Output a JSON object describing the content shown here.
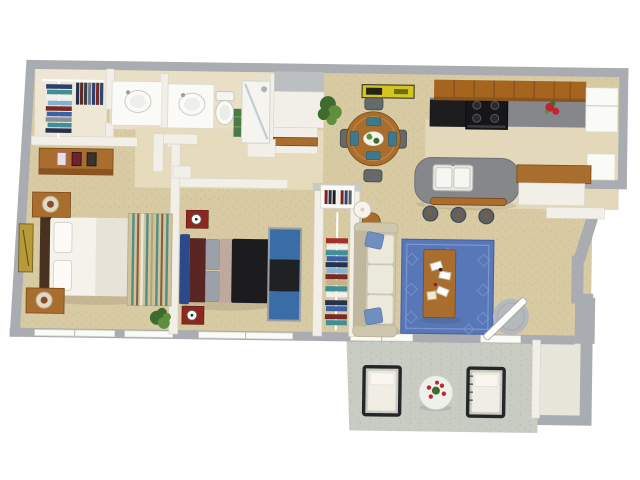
{
  "palette": {
    "bg": "#ffffff",
    "wall": "#a9acb0",
    "wallLight": "#bcbfc2",
    "partition": "#f2efe8",
    "partitionEdge": "#d9d4c8",
    "carpet": "#d8cba4",
    "tileBath": "#e9dfc6",
    "tileHall": "#e6dbbd",
    "tileKitchen": "#e3d8ba",
    "closetFloor": "#eee7d6",
    "concrete": "#c8ccc3",
    "storageFloor": "#e6e6da",
    "wood": "#a96e2e",
    "woodDark": "#7a4a16",
    "woodCab": "#a5651f",
    "counter": "#85878a",
    "applianceBlack": "#1d1d20",
    "white": "#fafaf6",
    "bedWhite": "#f4f2ea",
    "bedThrow": "#e7e3d8",
    "headboard": "#46321f",
    "sofa": "#cfc6ae",
    "sofaBack": "#c0b79e",
    "cushion": "#ebe8dc",
    "pillowBlue": "#6f8fc0",
    "rugBlue": "#5877b8",
    "rugBlueLine": "#7e96cc",
    "rug2Blue": "#3a6ca6",
    "rug2Black": "#202124",
    "rug2Border": "#9aa0a6",
    "bed2Blue": "#2b4a8c",
    "bed2Maroon": "#5a2522",
    "bed2Gray": "#9aa1a8",
    "bed2Tan": "#bfa89e",
    "bed2Black": "#1c1c1f",
    "nightstandRed": "#8f2720",
    "artGold": "#b89a3a",
    "artYellow": "#d4c420",
    "plant": "#3f6b2f",
    "plantLight": "#5e8f3c",
    "flowerRed": "#c22530",
    "stripeTeal": "#4e8f8a",
    "stripeBrown": "#8a5a3a",
    "rugTanBase": "#cfc29c",
    "mat": "#b6b9bc",
    "glass": "#b9c6cc"
  },
  "scene": {
    "type": "3d-apartment-floor-plan",
    "rooms": [
      {
        "name": "Walk-in closet",
        "furniture": [
          "hanging-clothes",
          "clothes-rod"
        ]
      },
      {
        "name": "Bathroom",
        "furniture": [
          "vanity-sink",
          "vanity-sink",
          "toilet",
          "shower",
          "towels"
        ]
      },
      {
        "name": "Master bedroom",
        "furniture": [
          "double-bed",
          "dresser",
          "nightstand-lamp",
          "nightstand-lamp",
          "striped-rug",
          "wall-art",
          "plant"
        ]
      },
      {
        "name": "Bedroom 2",
        "furniture": [
          "double-bed",
          "nightstand-clock",
          "nightstand-clock",
          "area-rug"
        ]
      },
      {
        "name": "Hall closet",
        "furniture": [
          "bookshelf",
          "hanging-clothes"
        ]
      },
      {
        "name": "Living room",
        "furniture": [
          "sofa",
          "blue-rug",
          "coffee-table",
          "floor-lamp",
          "side-table",
          "entry-mat"
        ]
      },
      {
        "name": "Dining area",
        "furniture": [
          "round-table",
          "chairs",
          "wall-art",
          "plant"
        ]
      },
      {
        "name": "Kitchen",
        "furniture": [
          "upper-cabinets",
          "counter",
          "stove",
          "refrigerator",
          "island-sink",
          "bar-counter",
          "bar-stools",
          "flowers"
        ]
      },
      {
        "name": "Entry",
        "furniture": [
          "door",
          "round-mat"
        ]
      },
      {
        "name": "Patio",
        "furniture": [
          "lounge-chair",
          "lounge-chair",
          "round-table-flowers",
          "storage-closet"
        ]
      }
    ]
  }
}
